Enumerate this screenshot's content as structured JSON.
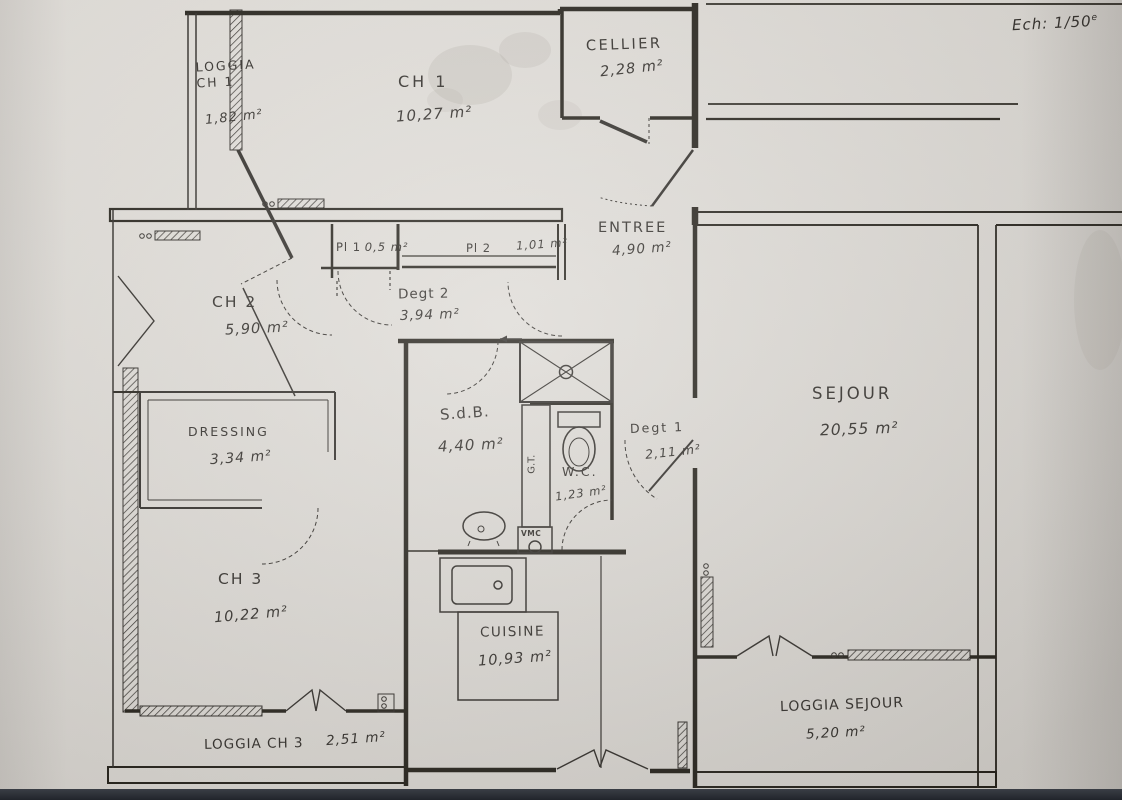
{
  "meta": {
    "document_type": "hand-drawn apartment floor plan",
    "scale_label": "Ech: 1/50",
    "scale_sup": "e"
  },
  "rooms": [
    {
      "id": "loggia-ch1",
      "name": "LOGGIA",
      "name2": "CH 1",
      "area": "1,82 m²"
    },
    {
      "id": "ch1",
      "name": "CH 1",
      "area": "10,27 m²"
    },
    {
      "id": "cellier",
      "name": "CELLIER",
      "area": "2,28 m²"
    },
    {
      "id": "entree",
      "name": "ENTREE",
      "area": "4,90 m²"
    },
    {
      "id": "pl1",
      "name": "Pl 1",
      "area": "0,5 m²"
    },
    {
      "id": "pl2",
      "name": "Pl 2",
      "area": "1,01 m²"
    },
    {
      "id": "degt2",
      "name": "Degt 2",
      "area": "3,94 m²"
    },
    {
      "id": "ch2",
      "name": "CH 2",
      "area": "5,90 m²"
    },
    {
      "id": "dressing",
      "name": "DRESSING",
      "area": "3,34 m²"
    },
    {
      "id": "sdb",
      "name": "S.d.B.",
      "area": "4,40 m²"
    },
    {
      "id": "wc",
      "name": "W.C.",
      "area": "1,23 m²"
    },
    {
      "id": "degt1",
      "name": "Degt 1",
      "area": "2,11 m²"
    },
    {
      "id": "sejour",
      "name": "SEJOUR",
      "area": "20,55 m²"
    },
    {
      "id": "ch3",
      "name": "CH 3",
      "area": "10,22 m²"
    },
    {
      "id": "cuisine",
      "name": "CUISINE",
      "area": "10,93 m²"
    },
    {
      "id": "loggia-ch3",
      "name": "LOGGIA CH 3",
      "area": "2,51 m²"
    },
    {
      "id": "loggia-sejour",
      "name": "LOGGIA SEJOUR",
      "area": "5,20 m²"
    }
  ],
  "annotations": {
    "vmc": "VMC",
    "gt": "G.T."
  },
  "colors": {
    "paper": "#dcd8d3",
    "ink": "#2e2b27",
    "photo_edge": "#23262c"
  }
}
